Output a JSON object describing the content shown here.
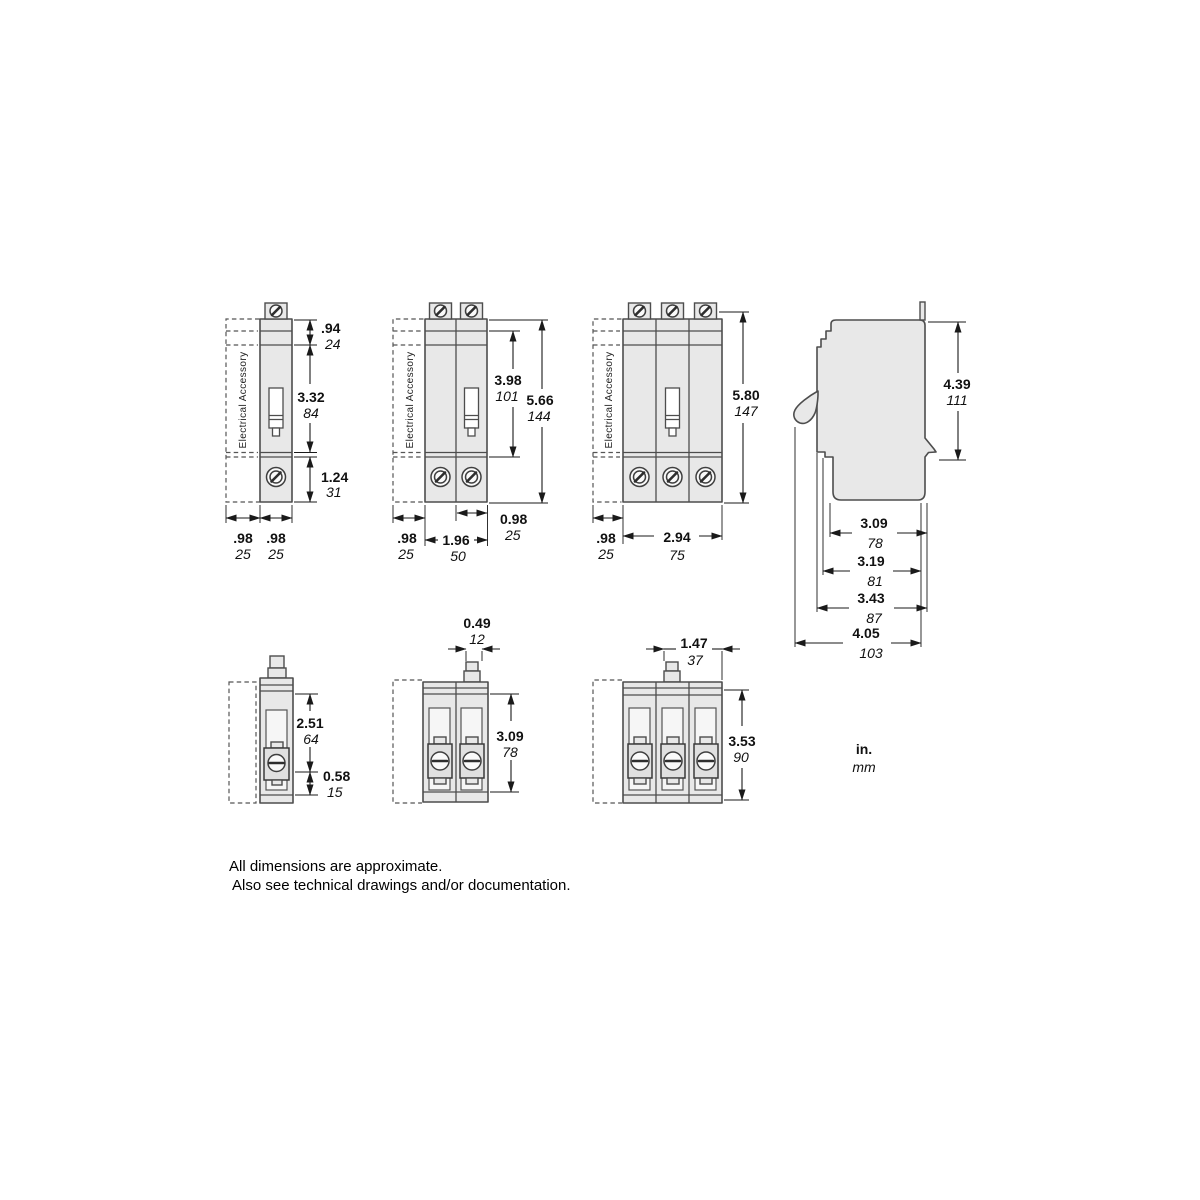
{
  "colors": {
    "background": "#ffffff",
    "body_fill": "#e8e8e8",
    "outline": "#4d4d4d",
    "dimension": "#1a1a1a"
  },
  "accessory_label": "Electrical Accessory",
  "units_legend": {
    "in": "in.",
    "mm": "mm"
  },
  "notes": {
    "line1": "All dimensions are approximate.",
    "line2": "Also see technical drawings and/or documentation."
  },
  "figures": {
    "front_1pole": {
      "dims": {
        "top_section": {
          "in": ".94",
          "mm": "24"
        },
        "middle_section": {
          "in": "3.32",
          "mm": "84"
        },
        "bottom_section": {
          "in": "1.24",
          "mm": "31"
        },
        "accessory_width": {
          "in": ".98",
          "mm": "25"
        },
        "pole_width": {
          "in": ".98",
          "mm": "25"
        }
      }
    },
    "front_2pole": {
      "dims": {
        "inner_height": {
          "in": "3.98",
          "mm": "101"
        },
        "total_height": {
          "in": "5.66",
          "mm": "144"
        },
        "pole_width": {
          "in": "0.98",
          "mm": "25"
        },
        "accessory_width": {
          "in": ".98",
          "mm": "25"
        },
        "total_width": {
          "in": "1.96",
          "mm": "50"
        }
      }
    },
    "front_3pole": {
      "dims": {
        "total_height": {
          "in": "5.80",
          "mm": "147"
        },
        "accessory_width": {
          "in": ".98",
          "mm": "25"
        },
        "total_width": {
          "in": "2.94",
          "mm": "75"
        }
      }
    },
    "side": {
      "dims": {
        "height": {
          "in": "4.39",
          "mm": "111"
        },
        "depth_body": {
          "in": "3.09",
          "mm": "78"
        },
        "depth_step": {
          "in": "3.19",
          "mm": "81"
        },
        "depth_flange": {
          "in": "3.43",
          "mm": "87"
        },
        "depth_overall": {
          "in": "4.05",
          "mm": "103"
        }
      }
    },
    "bottom_1pole": {
      "dims": {
        "body_depth": {
          "in": "2.51",
          "mm": "64"
        },
        "lug_depth": {
          "in": "0.58",
          "mm": "15"
        }
      }
    },
    "bottom_2pole": {
      "dims": {
        "handle_width": {
          "in": "0.49",
          "mm": "12"
        },
        "body_depth": {
          "in": "3.09",
          "mm": "78"
        }
      }
    },
    "bottom_3pole": {
      "dims": {
        "handle_offset": {
          "in": "1.47",
          "mm": "37"
        },
        "body_depth": {
          "in": "3.53",
          "mm": "90"
        }
      }
    }
  }
}
